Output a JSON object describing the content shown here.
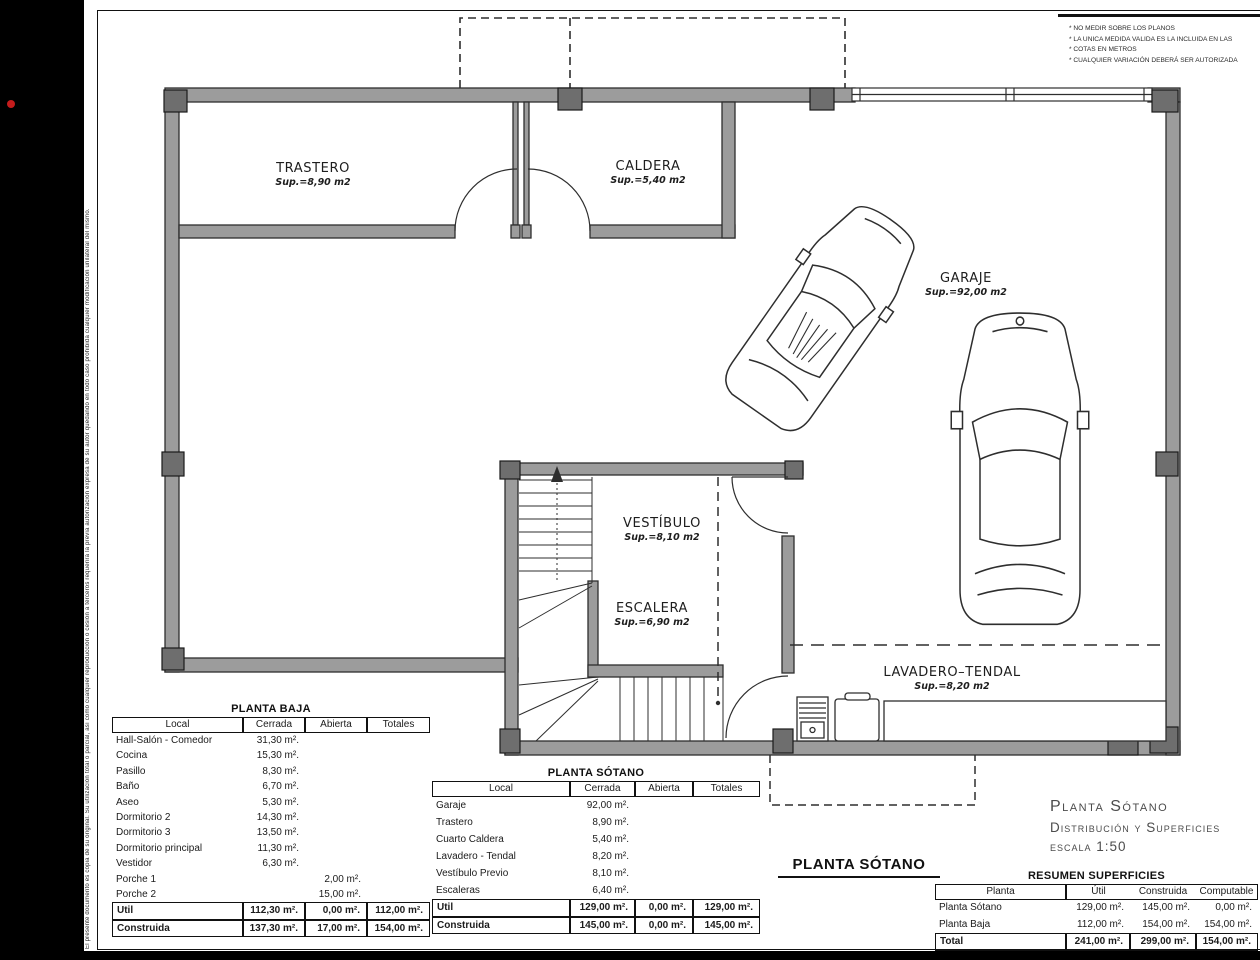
{
  "notes": {
    "lines": [
      "* NO MEDIR SOBRE LOS PLANOS",
      "* LA UNICA MEDIDA VALIDA ES LA INCLUIDA EN LAS",
      "* COTAS EN METROS",
      "* CUALQUIER VARIACIÓN DEBERÁ SER AUTORIZADA"
    ]
  },
  "side_text": "El presente documento es copia de su original. Su utilización total o parcial, así como cualquier reproducción o cesión a terceros requerirá la previa autorización expresa de su autor quedando en todo caso prohibida cualquier modificación unilateral del mismo.",
  "plan": {
    "rooms": [
      {
        "name": "TRASTERO",
        "sup": "Sup.=8,90  m2"
      },
      {
        "name": "CALDERA",
        "sup": "Sup.=5,40  m2"
      },
      {
        "name": "GARAJE",
        "sup": "Sup.=92,00  m2"
      },
      {
        "name": "VESTÍBULO",
        "sup": "Sup.=8,10  m2"
      },
      {
        "name": "ESCALERA",
        "sup": "Sup.=6,90  m2"
      },
      {
        "name": "LAVADERO–TENDAL",
        "sup": "Sup.=8,20  m2"
      }
    ]
  },
  "titles": {
    "plan_label": "PLANTA SÓTANO",
    "line1": "Planta Sótano",
    "line2": "Distribución y Superficies",
    "line3": "escala 1:50"
  },
  "tables": {
    "planta_baja": {
      "title": "PLANTA BAJA",
      "headers": [
        "Local",
        "Cerrada",
        "Abierta",
        "Totales"
      ],
      "rows": [
        {
          "cells": [
            "Hall-Salón - Comedor",
            "31,30 m².",
            "",
            ""
          ],
          "total": false
        },
        {
          "cells": [
            "Cocina",
            "15,30 m².",
            "",
            ""
          ],
          "total": false
        },
        {
          "cells": [
            "Pasillo",
            "8,30 m².",
            "",
            ""
          ],
          "total": false
        },
        {
          "cells": [
            "Baño",
            "6,70 m².",
            "",
            ""
          ],
          "total": false
        },
        {
          "cells": [
            "Aseo",
            "5,30 m².",
            "",
            ""
          ],
          "total": false
        },
        {
          "cells": [
            "Dormitorio 2",
            "14,30 m².",
            "",
            ""
          ],
          "total": false
        },
        {
          "cells": [
            "Dormitorio 3",
            "13,50 m².",
            "",
            ""
          ],
          "total": false
        },
        {
          "cells": [
            "Dormitorio principal",
            "11,30 m².",
            "",
            ""
          ],
          "total": false
        },
        {
          "cells": [
            "Vestidor",
            "6,30 m².",
            "",
            ""
          ],
          "total": false
        },
        {
          "cells": [
            "Porche 1",
            "",
            "2,00 m².",
            ""
          ],
          "total": false
        },
        {
          "cells": [
            "Porche 2",
            "",
            "15,00 m².",
            ""
          ],
          "total": false
        },
        {
          "cells": [
            "Util",
            "112,30 m².",
            "0,00 m².",
            "112,00 m²."
          ],
          "total": true
        },
        {
          "cells": [
            "Construida",
            "137,30 m².",
            "17,00 m².",
            "154,00 m²."
          ],
          "total": true
        }
      ]
    },
    "planta_sotano": {
      "title": "PLANTA SÓTANO",
      "headers": [
        "Local",
        "Cerrada",
        "Abierta",
        "Totales"
      ],
      "rows": [
        {
          "cells": [
            "Garaje",
            "92,00 m².",
            "",
            ""
          ],
          "total": false
        },
        {
          "cells": [
            "Trastero",
            "8,90 m².",
            "",
            ""
          ],
          "total": false
        },
        {
          "cells": [
            "Cuarto Caldera",
            "5,40 m².",
            "",
            ""
          ],
          "total": false
        },
        {
          "cells": [
            "Lavadero - Tendal",
            "8,20 m².",
            "",
            ""
          ],
          "total": false
        },
        {
          "cells": [
            "Vestíbulo Previo",
            "8,10 m².",
            "",
            ""
          ],
          "total": false
        },
        {
          "cells": [
            "Escaleras",
            "6,40 m².",
            "",
            ""
          ],
          "total": false
        },
        {
          "cells": [
            "Util",
            "129,00 m².",
            "0,00 m².",
            "129,00 m²."
          ],
          "total": true
        },
        {
          "cells": [
            "Construida",
            "145,00 m².",
            "0,00 m².",
            "145,00 m²."
          ],
          "total": true
        }
      ]
    },
    "resumen": {
      "title": "RESUMEN SUPERFICIES",
      "headers": [
        "Planta",
        "Útil",
        "Construida",
        "Computable"
      ],
      "rows": [
        {
          "cells": [
            "Planta Sótano",
            "129,00 m².",
            "145,00 m².",
            "0,00 m²."
          ],
          "total": false
        },
        {
          "cells": [
            "Planta Baja",
            "112,00 m².",
            "154,00 m².",
            "154,00 m²."
          ],
          "total": false
        },
        {
          "cells": [
            "Total",
            "241,00 m².",
            "299,00 m².",
            "154,00 m²."
          ],
          "total": true
        }
      ]
    }
  },
  "colors": {
    "wall": "#9c9c9c",
    "pillar": "#6e6e6e",
    "line": "#2e2e2e",
    "accent_dot": "#c41c1c"
  }
}
